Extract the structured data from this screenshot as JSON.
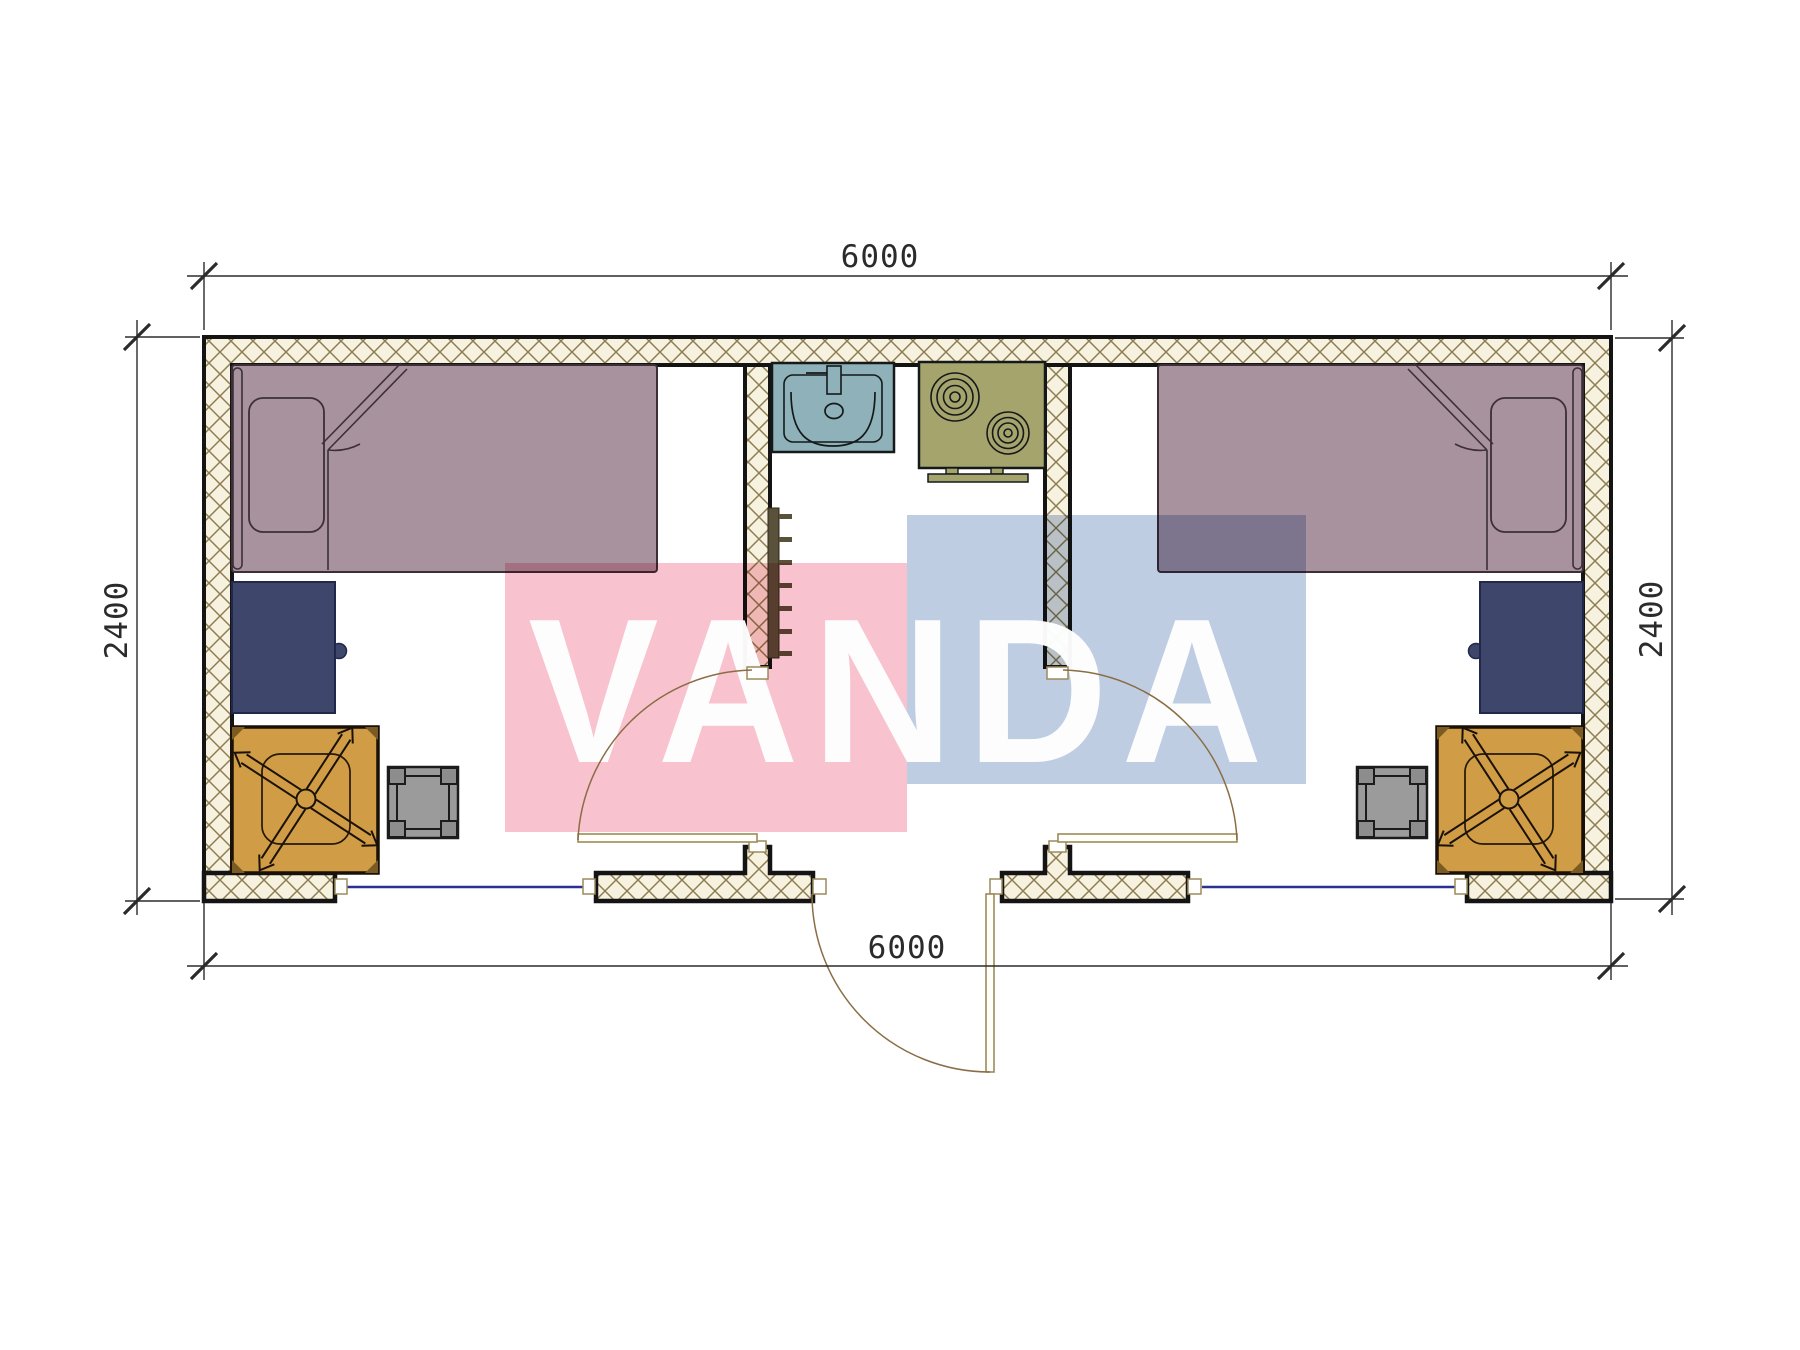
{
  "drawing": {
    "type": "floor-plan",
    "watermark": {
      "text": "VANDA",
      "pink": "#f8c3ce",
      "blue": "#bfcde3",
      "text_color": "#ffffff"
    },
    "dimensions": {
      "top": "6000",
      "bottom": "6000",
      "left": "2400",
      "right": "2400"
    },
    "palette": {
      "hatch_bg": "#f7f1e0",
      "hatch_line": "#8d7d52",
      "wall_line": "#141414",
      "bed": "#a7929e",
      "bed_line": "#3c2f38",
      "desk": "#3e466b",
      "desk_line": "#22284a",
      "mat": "#d09c45",
      "stool": "#9b9b9b",
      "sink": "#8fb1b9",
      "stove": "#a5a46c",
      "stove_line": "#15191a",
      "radiator": "#5a513a",
      "threshold": "#2b3191",
      "door": "#9c8a5a",
      "door_arc": "#8a6d45",
      "dim_line": "#2b2b2b"
    },
    "symbols": [
      "bed",
      "pillow",
      "desk",
      "office-chair",
      "stool",
      "sink",
      "stove",
      "towel-radiator",
      "door-swing",
      "threshold"
    ]
  }
}
